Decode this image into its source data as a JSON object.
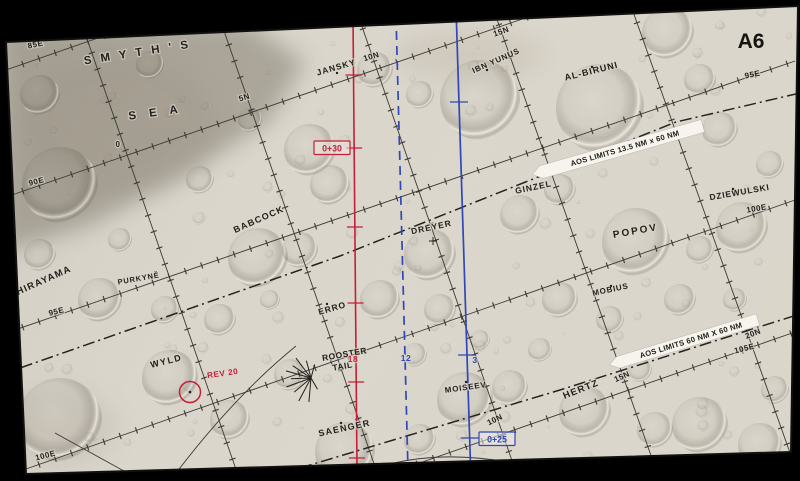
{
  "sheet": {
    "label": "A6"
  },
  "map": {
    "colors": {
      "bg": "#000000",
      "paper": "#d9d5cb",
      "mare": "#a39d91",
      "grid": "#3b3a33",
      "track": "#24231f",
      "red": "#c41f38",
      "blue": "#2f48b5",
      "banner_bg": "#f6f4ed",
      "ink": "#23211c",
      "halo": "rgba(218,214,204,0.65)"
    },
    "outline": [
      [
        6,
        42
      ],
      [
        798,
        6
      ],
      [
        791,
        452
      ],
      [
        26,
        474
      ]
    ],
    "place_labels": [
      {
        "text": "S M Y T H ' S",
        "x": 138,
        "y": 56,
        "rot": -9,
        "fs": 11.5,
        "ls": 3,
        "w": 600
      },
      {
        "text": "S E A",
        "x": 156,
        "y": 116,
        "rot": -8,
        "fs": 11.5,
        "ls": 5,
        "w": 600
      },
      {
        "text": "JANSKY",
        "x": 337,
        "y": 70,
        "rot": -16,
        "fs": 8.5,
        "ls": 1,
        "w": 600
      },
      {
        "text": "IBN YUNUS",
        "x": 497,
        "y": 63,
        "rot": -24,
        "fs": 8,
        "ls": 0.8,
        "w": 600
      },
      {
        "text": "AL-BIRUNI",
        "x": 592,
        "y": 74,
        "rot": -14,
        "fs": 9,
        "ls": 1,
        "w": 600
      },
      {
        "text": "BABCOCK",
        "x": 260,
        "y": 222,
        "rot": -24,
        "fs": 9,
        "ls": 1.2,
        "w": 600
      },
      {
        "text": "DREYER",
        "x": 432,
        "y": 230,
        "rot": -12,
        "fs": 8.5,
        "ls": 1,
        "w": 600
      },
      {
        "text": "GINZEL",
        "x": 534,
        "y": 190,
        "rot": -12,
        "fs": 8.5,
        "ls": 1,
        "w": 600
      },
      {
        "text": "DZIEWULSKI",
        "x": 740,
        "y": 195,
        "rot": -10,
        "fs": 8.5,
        "ls": 0.8,
        "w": 600
      },
      {
        "text": "POPOV",
        "x": 636,
        "y": 234,
        "rot": -10,
        "fs": 10,
        "ls": 2,
        "w": 600
      },
      {
        "text": "MOBIUS",
        "x": 611,
        "y": 292,
        "rot": -12,
        "fs": 8,
        "ls": 0.8,
        "w": 600
      },
      {
        "text": "HIRAYAMA",
        "x": 45,
        "y": 283,
        "rot": -24,
        "fs": 9.5,
        "ls": 1.2,
        "w": 600
      },
      {
        "text": "PURKYNĚ",
        "x": 139,
        "y": 281,
        "rot": -10,
        "fs": 7.5,
        "ls": 0.8,
        "w": 600
      },
      {
        "text": "ERRO",
        "x": 333,
        "y": 311,
        "rot": -16,
        "fs": 8.5,
        "ls": 1,
        "w": 600
      },
      {
        "text": "WYLD",
        "x": 167,
        "y": 364,
        "rot": -14,
        "fs": 9,
        "ls": 1.5,
        "w": 600
      },
      {
        "text": "SAENGER",
        "x": 345,
        "y": 431,
        "rot": -12,
        "fs": 9,
        "ls": 1.2,
        "w": 600
      },
      {
        "text": "MOISEEV",
        "x": 466,
        "y": 390,
        "rot": -8,
        "fs": 8,
        "ls": 0.8,
        "w": 600
      },
      {
        "text": "HERTZ",
        "x": 582,
        "y": 392,
        "rot": -22,
        "fs": 9.5,
        "ls": 1.2,
        "w": 600
      },
      {
        "text": "ROOSTER",
        "x": 345,
        "y": 357,
        "rot": -10,
        "fs": 8.5,
        "ls": 0.5,
        "w": 700
      },
      {
        "text": "TAIL",
        "x": 343,
        "y": 369,
        "rot": -10,
        "fs": 8.5,
        "ls": 0.5,
        "w": 700
      }
    ],
    "grid_labels": [
      {
        "text": "85E",
        "x": 36,
        "y": 47,
        "rot": -12,
        "fs": 8
      },
      {
        "text": "90E",
        "x": 37,
        "y": 184,
        "rot": -14,
        "fs": 8
      },
      {
        "text": "95E",
        "x": 57,
        "y": 314,
        "rot": -14,
        "fs": 8
      },
      {
        "text": "100E",
        "x": 46,
        "y": 458,
        "rot": -14,
        "fs": 8
      },
      {
        "text": "0",
        "x": 118,
        "y": 147,
        "rot": 0,
        "fs": 8
      },
      {
        "text": "5N",
        "x": 245,
        "y": 100,
        "rot": -16,
        "fs": 8
      },
      {
        "text": "10N",
        "x": 372,
        "y": 59,
        "rot": -16,
        "fs": 8
      },
      {
        "text": "15N",
        "x": 502,
        "y": 34,
        "rot": -20,
        "fs": 8
      },
      {
        "text": "95E",
        "x": 753,
        "y": 77,
        "rot": -12,
        "fs": 8
      },
      {
        "text": "100E",
        "x": 757,
        "y": 211,
        "rot": -10,
        "fs": 8
      },
      {
        "text": "105E",
        "x": 745,
        "y": 351,
        "rot": -14,
        "fs": 8
      },
      {
        "text": "20N",
        "x": 754,
        "y": 336,
        "rot": -22,
        "fs": 8
      },
      {
        "text": "15N",
        "x": 623,
        "y": 379,
        "rot": -24,
        "fs": 8
      },
      {
        "text": "10N",
        "x": 496,
        "y": 422,
        "rot": -26,
        "fs": 8
      }
    ],
    "red_labels": [
      {
        "text": "REV 20",
        "x": 223,
        "y": 376,
        "rot": -8,
        "fs": 8.2
      },
      {
        "text": "18",
        "x": 353,
        "y": 362,
        "rot": 0,
        "fs": 8.5
      }
    ],
    "blue_labels": [
      {
        "text": "12",
        "x": 406,
        "y": 361,
        "rot": 0,
        "fs": 8.5
      },
      {
        "text": "3",
        "x": 475,
        "y": 363,
        "rot": 0,
        "fs": 8.5
      }
    ],
    "boxed_labels": [
      {
        "text": "0+30",
        "x": 332,
        "y": 148,
        "color": "red"
      },
      {
        "text": "0+25",
        "x": 497,
        "y": 439,
        "color": "blue"
      }
    ],
    "banners": [
      {
        "text": "AOS LIMITS 13.5 NM x 60 NM",
        "x": 622,
        "y": 149,
        "rot": -16,
        "w": 168,
        "h": 13
      },
      {
        "text": "AOS LIMITS 60 NM X 60 NM",
        "x": 688,
        "y": 341,
        "rot": -17,
        "w": 146,
        "h": 12
      }
    ],
    "grid_lines": {
      "latitude": [
        [
          86,
          36,
          240,
          481
        ],
        [
          223,
          28,
          380,
          481
        ],
        [
          357,
          12,
          519,
          481
        ],
        [
          493,
          8,
          660,
          481
        ],
        [
          631,
          6,
          794,
          464
        ]
      ],
      "meridian": [
        [
          6,
          70,
          190,
          6
        ],
        [
          6,
          197,
          560,
          6
        ],
        [
          6,
          333,
          795,
          61
        ],
        [
          6,
          476,
          795,
          200
        ],
        [
          368,
          481,
          795,
          332
        ]
      ]
    },
    "tracks": {
      "upper": [
        [
          0,
          375
        ],
        [
          340,
          256
        ],
        [
          676,
          122
        ],
        [
          800,
          93
        ]
      ],
      "lower": [
        [
          300,
          468
        ],
        [
          560,
          390
        ],
        [
          800,
          314
        ]
      ]
    },
    "thin_curves": [
      "M170,481 Q232,398 296,346",
      "M55,433 L142,481",
      "M362,473 Q450,438 575,479"
    ],
    "red_line": {
      "x1": 353,
      "y1": 18,
      "x2": 357,
      "y2": 468,
      "ticks": [
        75,
        148,
        227,
        303,
        382,
        458
      ]
    },
    "blue_solid": {
      "x1": 456,
      "y1": 8,
      "x2": 471,
      "y2": 481,
      "ticks": [
        102,
        355,
        438
      ]
    },
    "blue_dashed": {
      "x1": 396,
      "y1": 16,
      "x2": 408,
      "y2": 470
    },
    "rev_circle": {
      "x": 190,
      "y": 392,
      "r": 10.5
    },
    "rooster_tail": {
      "x": 311,
      "y": 378
    },
    "mare_polygon": [
      [
        0,
        28
      ],
      [
        245,
        22
      ],
      [
        305,
        62
      ],
      [
        268,
        122
      ],
      [
        188,
        172
      ],
      [
        88,
        226
      ],
      [
        0,
        252
      ]
    ],
    "crater_dots": [
      [
        337,
        73
      ],
      [
        592,
        67
      ],
      [
        487,
        70
      ],
      [
        611,
        286
      ],
      [
        327,
        304
      ],
      [
        466,
        382
      ],
      [
        733,
        189
      ],
      [
        341,
        423
      ]
    ],
    "crater_cross": [
      433,
      241
    ],
    "craters": [
      [
        60,
        185,
        38
      ],
      [
        40,
        95,
        20
      ],
      [
        150,
        65,
        14
      ],
      [
        310,
        150,
        26
      ],
      [
        330,
        185,
        20
      ],
      [
        480,
        100,
        40
      ],
      [
        600,
        108,
        44
      ],
      [
        668,
        33,
        26
      ],
      [
        700,
        80,
        16
      ],
      [
        258,
        258,
        30
      ],
      [
        300,
        250,
        18
      ],
      [
        430,
        255,
        26
      ],
      [
        520,
        215,
        20
      ],
      [
        560,
        190,
        16
      ],
      [
        636,
        242,
        34
      ],
      [
        742,
        228,
        26
      ],
      [
        700,
        250,
        14
      ],
      [
        100,
        300,
        22
      ],
      [
        40,
        255,
        16
      ],
      [
        165,
        310,
        14
      ],
      [
        220,
        320,
        16
      ],
      [
        380,
        300,
        20
      ],
      [
        440,
        310,
        16
      ],
      [
        560,
        300,
        18
      ],
      [
        610,
        320,
        14
      ],
      [
        680,
        300,
        16
      ],
      [
        60,
        420,
        42
      ],
      [
        170,
        378,
        28
      ],
      [
        230,
        420,
        20
      ],
      [
        290,
        375,
        16
      ],
      [
        345,
        452,
        30
      ],
      [
        420,
        440,
        16
      ],
      [
        465,
        400,
        28
      ],
      [
        510,
        388,
        18
      ],
      [
        585,
        412,
        26
      ],
      [
        655,
        430,
        18
      ],
      [
        700,
        425,
        28
      ],
      [
        760,
        445,
        22
      ],
      [
        775,
        390,
        14
      ],
      [
        375,
        70,
        18
      ],
      [
        420,
        95,
        14
      ],
      [
        250,
        120,
        12
      ],
      [
        200,
        180,
        14
      ],
      [
        120,
        240,
        12
      ],
      [
        720,
        130,
        18
      ],
      [
        770,
        165,
        14
      ],
      [
        735,
        300,
        12
      ],
      [
        640,
        370,
        12
      ],
      [
        540,
        350,
        12
      ],
      [
        480,
        340,
        10
      ],
      [
        415,
        355,
        12
      ],
      [
        270,
        300,
        10
      ]
    ]
  }
}
